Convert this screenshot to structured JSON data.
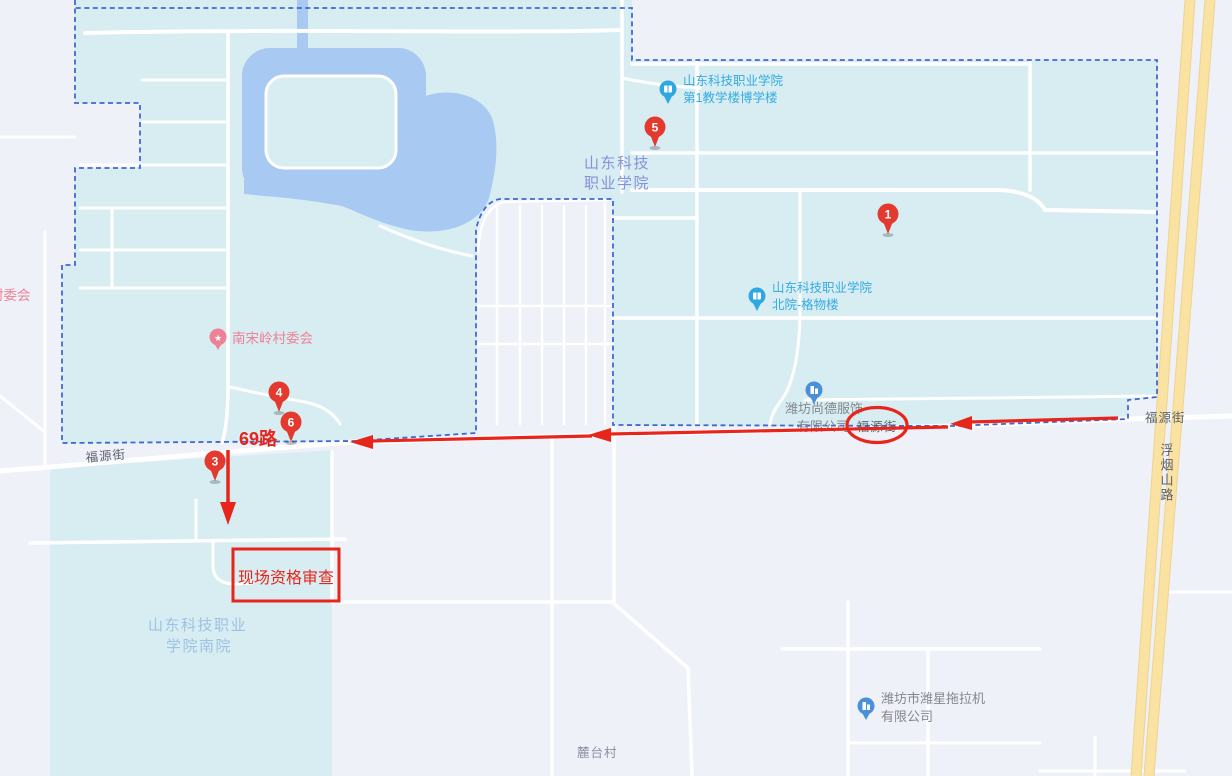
{
  "map": {
    "labels": {
      "poi_building1": {
        "line1": "山东科技职业学院",
        "line2": "第1教学楼博学楼"
      },
      "campus_north": {
        "line1": "山东科技",
        "line2": "职业学院"
      },
      "poi_building2": {
        "line1": "山东科技职业学院",
        "line2": "北院-格物楼"
      },
      "poi_company1": {
        "line1": "潍坊尚德服饰",
        "line2": "有限公司"
      },
      "poi_company2": {
        "line1": "潍坊市潍星拖拉机",
        "line2": "有限公司"
      },
      "village_committee1": "南宋岭村委会",
      "village_committee2": "村委会",
      "campus_south": {
        "line1": "山东科技职业",
        "line2": "学院南院"
      },
      "village1": "麓台村",
      "road_fuyuan_left": "福源街",
      "road_fuyuan_circled": "福源街",
      "road_fuyuan_right": "福源街",
      "road_fuyanshan": "浮烟山路"
    },
    "annotations": {
      "bus_route": "69路",
      "site_check": "现场资格审查"
    },
    "markers": [
      {
        "number": "1"
      },
      {
        "number": "3"
      },
      {
        "number": "4"
      },
      {
        "number": "5"
      },
      {
        "number": "6"
      }
    ]
  },
  "colors": {
    "campus_fill": "#d7edf2",
    "outside_fill": "#eef1f8",
    "water_fill": "#a7c9f2",
    "road_fill": "#ffffff",
    "major_road_fill": "#f9e2a2",
    "major_road_edge": "#f0d392",
    "boundary_dash": "#4168d2",
    "annotation_red": "#e8251b",
    "marker_red": "#e4392e",
    "poi_blue": "#36abe0",
    "poi_icon_blue": "#2ea7e2",
    "company_icon_blue": "#4a90d8",
    "campus_label_blue": "#8691dc",
    "campus_label_light": "#9dc2e2",
    "poi_gray": "#82878f",
    "village_pink": "#ef8196",
    "road_label_gray": "#5d646e"
  }
}
